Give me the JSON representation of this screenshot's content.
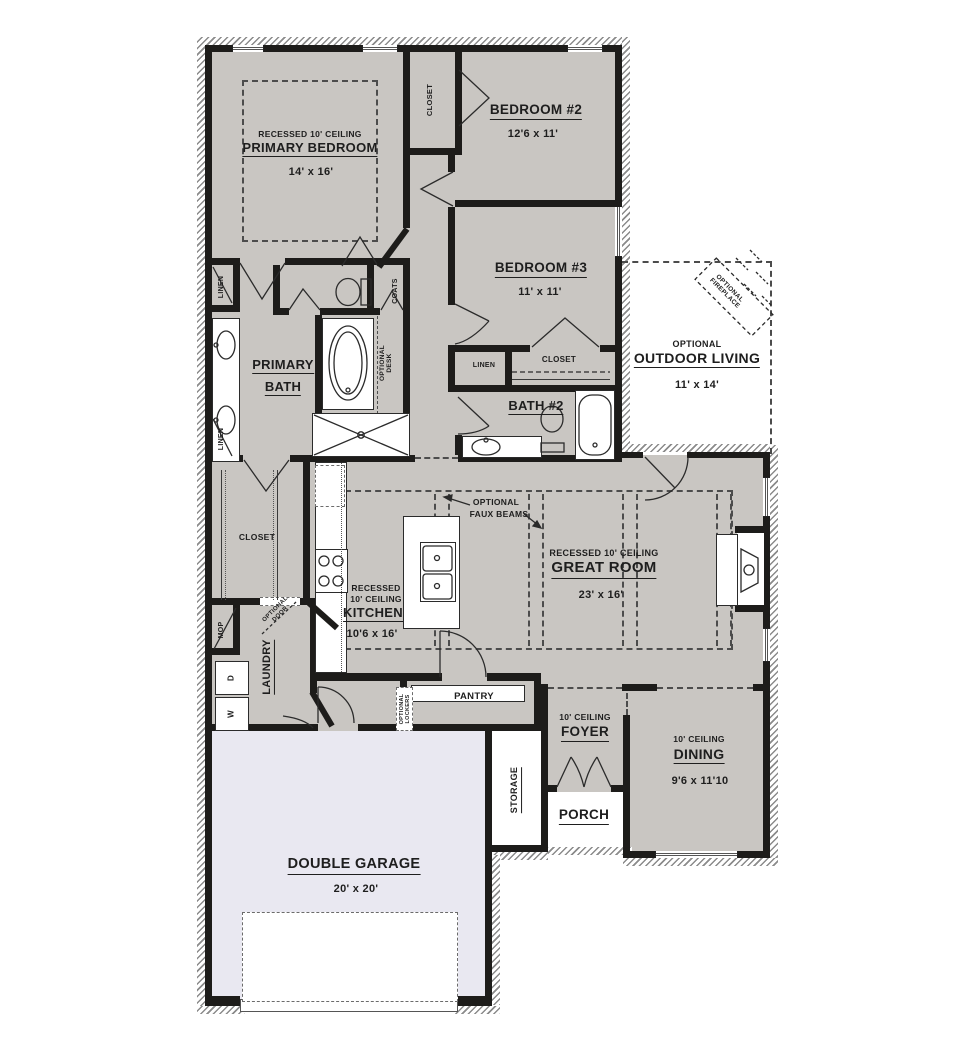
{
  "colors": {
    "interior_floor": "#c9c6c2",
    "garage_floor": "#e9e8f1",
    "wall": "#1d1c1a",
    "text": "#1e1e1e"
  },
  "rooms": {
    "primary_bedroom": {
      "note": "RECESSED 10' CEILING",
      "name": "PRIMARY BEDROOM",
      "dims": "14' x 16'"
    },
    "bedroom2": {
      "name": "BEDROOM #2",
      "dims": "12'6 x 11'"
    },
    "bedroom3": {
      "name": "BEDROOM #3",
      "dims": "11' x 11'"
    },
    "closet_top": {
      "name": "CLOSET"
    },
    "closet_bedroom3": {
      "name": "CLOSET"
    },
    "closet_walkin": {
      "name": "CLOSET"
    },
    "linen_hall": {
      "name": "LINEN"
    },
    "linen_bath": {
      "name": "LINEN"
    },
    "linen_bath2": {
      "name": "LINEN"
    },
    "coats": {
      "name": "COATS"
    },
    "primary_bath": {
      "name_line1": "PRIMARY",
      "name_line2": "BATH"
    },
    "bath2": {
      "name": "BATH #2"
    },
    "outdoor_living": {
      "note": "OPTIONAL",
      "name": "OUTDOOR LIVING",
      "dims": "11' x 14'"
    },
    "great_room": {
      "note": "RECESSED 10' CEILING",
      "name": "GREAT ROOM",
      "dims": "23' x 16'"
    },
    "kitchen": {
      "note_line1": "RECESSED",
      "note_line2": "10' CEILING",
      "name": "KITCHEN",
      "dims": "10'6 x 16'"
    },
    "pantry": {
      "name": "PANTRY"
    },
    "laundry": {
      "name": "LAUNDRY"
    },
    "mop": {
      "name": "MOP"
    },
    "foyer": {
      "note": "10' CEILING",
      "name": "FOYER"
    },
    "dining": {
      "note": "10' CEILING",
      "name": "DINING",
      "dims": "9'6 x 11'10"
    },
    "porch": {
      "name": "PORCH"
    },
    "storage": {
      "name": "STORAGE"
    },
    "garage": {
      "name": "DOUBLE GARAGE",
      "dims": "20' x 20'"
    }
  },
  "annotations": {
    "optional_fireplace": {
      "line1": "OPTIONAL",
      "line2": "FIREPLACE"
    },
    "faux_beams": {
      "line1": "OPTIONAL",
      "line2": "FAUX BEAMS"
    },
    "optional_desk": {
      "line1": "OPTIONAL",
      "line2": "DESK"
    },
    "optional_door": {
      "line1": "OPTIONAL",
      "line2": "DOOR"
    },
    "optional_lockers": {
      "line1": "OPTIONAL",
      "line2": "LOCKERS"
    },
    "washer": "W",
    "dryer": "D"
  }
}
